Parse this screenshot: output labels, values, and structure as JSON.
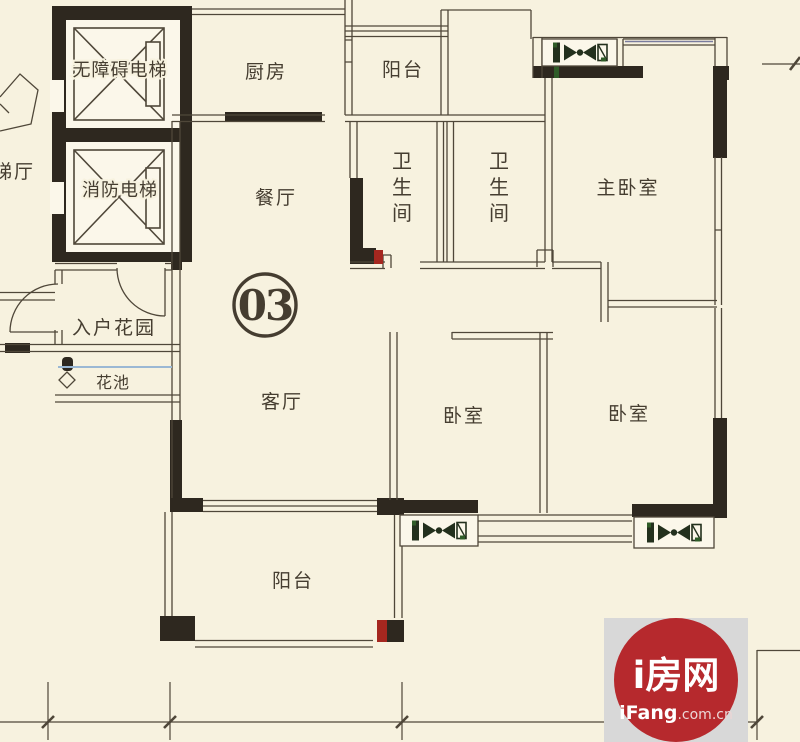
{
  "colors": {
    "background": "#f7f2df",
    "paper_white": "#fbf7ea",
    "wall": "#2e281f",
    "line": "#4f4739",
    "text": "#453d30",
    "accent_red": "#a5271f",
    "flower_line_blue": "#9bb8d4",
    "window_line_blue": "#7a7c9e",
    "ac_green": "#2f5c28",
    "logo_red": "#b6292d",
    "logo_bg": "#d8d8d8",
    "logo_text": "#ffffff"
  },
  "unit": {
    "number": "03"
  },
  "rooms": {
    "kitchen": "厨房",
    "balcony_top": "阳台",
    "dining": "餐厅",
    "bathroom_1": "卫生间",
    "bathroom_2": "卫生间",
    "master_bedroom": "主卧室",
    "living": "客厅",
    "bedroom_1": "卧室",
    "bedroom_2": "卧室",
    "entry_garden": "入户花园",
    "flower_bed": "花池",
    "balcony_bottom": "阳台"
  },
  "core": {
    "elevator_1": "无障碍电梯",
    "elevator_2": "消防电梯",
    "lobby": "梯厅"
  },
  "watermark": {
    "name_cn": "i房网",
    "domain_bold": "iFang",
    "domain_rest": ".com.cn"
  },
  "icons": {
    "ac_unit": "ac-outdoor-unit-icon",
    "elevator_car": "elevator-crossed-box-icon",
    "flower_marker": "diamond-marker-icon"
  }
}
